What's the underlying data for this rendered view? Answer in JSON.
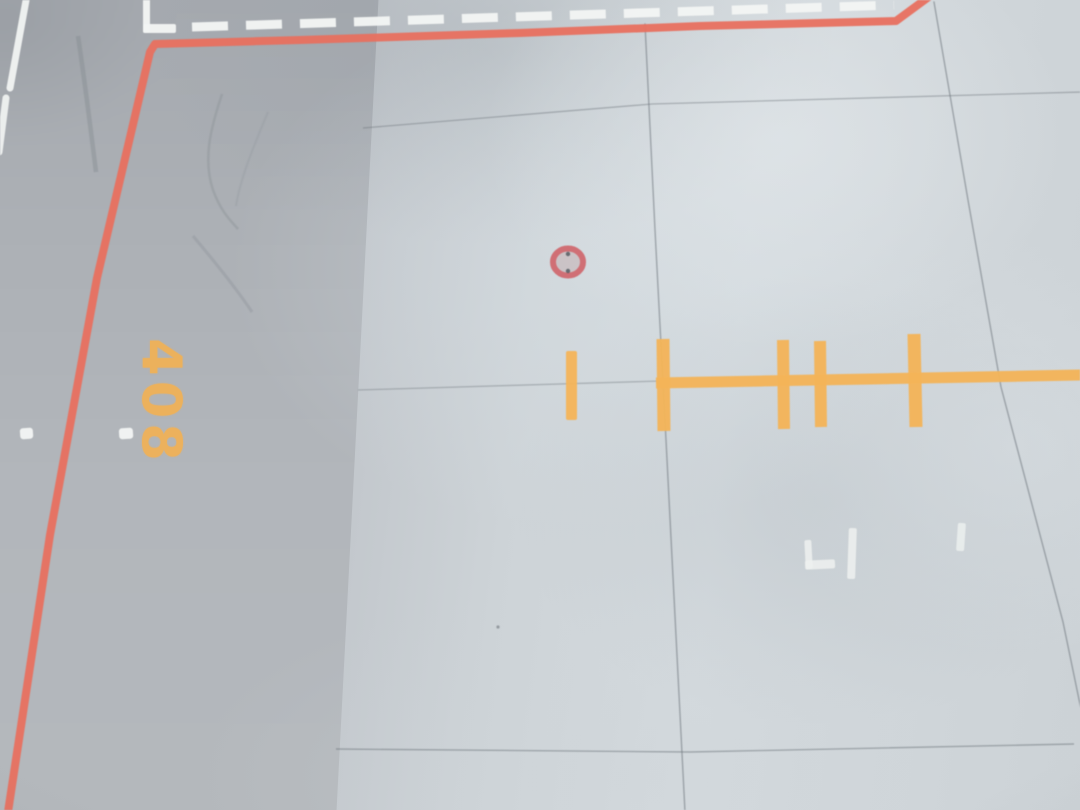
{
  "stand_number": {
    "text": "408",
    "color": "#f1b156"
  },
  "palette": {
    "apron_boundary_red": "#e8705f",
    "marking_yellow": "#f4b458",
    "marking_white": "#f3f5f4",
    "panel_seam_grey": "#6e757c",
    "grommet_ring_red": "#d0666c",
    "grommet_fill": "#c8bcbe",
    "surface_light": "#d4dade",
    "surface_dark": "#a6aaaf"
  },
  "shapes": [
    {
      "tag": "path",
      "name": "wrinkle-crease-1",
      "attrs": {
        "d": "M222,94 C210,130 203,160 213,190 C221,212 231,221 238,229",
        "stroke": "#8f949a",
        "stroke-width": "2.5",
        "fill": "none",
        "opacity": "0.45"
      }
    },
    {
      "tag": "path",
      "name": "wrinkle-crease-2",
      "attrs": {
        "d": "M193,236 C215,262 236,288 252,312",
        "stroke": "#8f949a",
        "stroke-width": "3",
        "fill": "none",
        "opacity": "0.4"
      }
    },
    {
      "tag": "path",
      "name": "wrinkle-crease-3",
      "attrs": {
        "d": "M268,112 C252,150 240,180 236,206",
        "stroke": "#93989e",
        "stroke-width": "2",
        "fill": "none",
        "opacity": "0.32"
      }
    },
    {
      "tag": "path",
      "name": "left-strip-scuff",
      "attrs": {
        "d": "M78,36 C86,90 92,140 96,172",
        "stroke": "#83898f",
        "stroke-width": "4.5",
        "fill": "none",
        "opacity": "0.4"
      }
    },
    {
      "tag": "polyline",
      "name": "panel-seam-vertical-center",
      "attrs": {
        "points": "645,24 655,230 666,440 685,812",
        "stroke": "#6e757c",
        "stroke-width": "1.4",
        "fill": "none",
        "opacity": "0.55",
        "stroke-linecap": "round"
      }
    },
    {
      "tag": "polyline",
      "name": "panel-seam-vertical-right",
      "attrs": {
        "points": "934,2 968,200 1001,387 1063,622 1082,714",
        "stroke": "#6e757c",
        "stroke-width": "1.4",
        "fill": "none",
        "opacity": "0.55",
        "stroke-linecap": "round"
      }
    },
    {
      "tag": "polyline",
      "name": "panel-seam-horizontal-top",
      "attrs": {
        "points": "363,128 652,104 1082,92",
        "stroke": "#6e757c",
        "stroke-width": "1.3",
        "fill": "none",
        "opacity": "0.45"
      }
    },
    {
      "tag": "line",
      "name": "panel-seam-horizontal-middle",
      "attrs": {
        "x1": "358",
        "y1": "390",
        "x2": "660",
        "y2": "381",
        "stroke": "#6e757c",
        "stroke-width": "1.3",
        "opacity": "0.4"
      }
    },
    {
      "tag": "polyline",
      "name": "panel-seam-horizontal-bottom",
      "attrs": {
        "points": "336,749 690,752 1074,744",
        "stroke": "#6e757c",
        "stroke-width": "1.4",
        "fill": "none",
        "opacity": "0.5"
      }
    },
    {
      "tag": "circle",
      "name": "dust-speck",
      "attrs": {
        "cx": "498",
        "cy": "627",
        "r": "1.6",
        "fill": "#7d838a",
        "opacity": "0.7"
      }
    },
    {
      "tag": "polyline",
      "name": "apron-boundary-red-line",
      "attrs": {
        "points": "8,812 50,535 97,278 150,52 155,44 300,40 520,33 700,26 896,21 930,-4",
        "stroke": "#e8705f",
        "stroke-width": "8",
        "fill": "none",
        "opacity": "0.95",
        "stroke-linejoin": "round",
        "stroke-linecap": "round"
      }
    },
    {
      "tag": "line",
      "name": "taxiway-edge-dashed-line",
      "attrs": {
        "x1": "192",
        "y1": "27",
        "x2": "894",
        "y2": "5",
        "stroke": "#f3f5f4",
        "stroke-width": "9",
        "stroke-dasharray": "36 18",
        "opacity": "0.96"
      }
    },
    {
      "tag": "rect",
      "name": "corner-mark-top-left-vertical",
      "attrs": {
        "x": "143",
        "y": "-2",
        "width": "7",
        "height": "35",
        "rx": "2",
        "fill": "#f3f5f4",
        "opacity": "0.96"
      }
    },
    {
      "tag": "rect",
      "name": "corner-mark-top-left-horizontal",
      "attrs": {
        "x": "143",
        "y": "24",
        "width": "33",
        "height": "9",
        "rx": "2",
        "fill": "#f3f5f4",
        "opacity": "0.96"
      }
    },
    {
      "tag": "line",
      "name": "runway-edge-line-upper",
      "attrs": {
        "x1": "27",
        "y1": "-5",
        "x2": "10",
        "y2": "88",
        "stroke": "#f3f5f4",
        "stroke-width": "7",
        "opacity": "0.94",
        "stroke-linecap": "round"
      }
    },
    {
      "tag": "line",
      "name": "runway-edge-line-lower",
      "attrs": {
        "x1": "6",
        "y1": "98",
        "x2": "-1",
        "y2": "152",
        "stroke": "#f3f5f4",
        "stroke-width": "7",
        "opacity": "0.9",
        "stroke-linecap": "round"
      }
    },
    {
      "tag": "rect",
      "name": "edge-dash-left",
      "attrs": {
        "x": "20",
        "y": "428",
        "width": "13",
        "height": "11",
        "rx": "3",
        "fill": "#f3f5f4",
        "opacity": "0.95",
        "transform": "rotate(-4 26 433)"
      }
    },
    {
      "tag": "rect",
      "name": "edge-dash-near-stand-number",
      "attrs": {
        "x": "119",
        "y": "428",
        "width": "14",
        "height": "11",
        "rx": "3",
        "fill": "#f3f5f4",
        "opacity": "0.95",
        "transform": "rotate(-4 126 433)"
      }
    },
    {
      "tag": "rect",
      "name": "yellow-stub-dash",
      "attrs": {
        "x": "566",
        "y": "351",
        "width": "11",
        "height": "69",
        "rx": "2",
        "fill": "#f4b458",
        "opacity": "0.95"
      }
    },
    {
      "tag": "line",
      "name": "stand-lead-in-line",
      "attrs": {
        "x1": "656",
        "y1": "383",
        "x2": "1082",
        "y2": "375",
        "stroke": "#f4b458",
        "stroke-width": "11",
        "opacity": "0.95"
      }
    },
    {
      "tag": "line",
      "name": "lead-in-crossbar-1",
      "attrs": {
        "x1": "663",
        "y1": "339",
        "x2": "664",
        "y2": "431",
        "stroke": "#f4b458",
        "stroke-width": "13",
        "opacity": "0.95"
      }
    },
    {
      "tag": "line",
      "name": "lead-in-crossbar-2",
      "attrs": {
        "x1": "783",
        "y1": "340",
        "x2": "784",
        "y2": "429",
        "stroke": "#f4b458",
        "stroke-width": "12",
        "opacity": "0.95"
      }
    },
    {
      "tag": "line",
      "name": "lead-in-crossbar-3",
      "attrs": {
        "x1": "820",
        "y1": "341",
        "x2": "821",
        "y2": "427",
        "stroke": "#f4b458",
        "stroke-width": "12",
        "opacity": "0.95"
      }
    },
    {
      "tag": "line",
      "name": "lead-in-crossbar-4",
      "attrs": {
        "x1": "914",
        "y1": "334",
        "x2": "916",
        "y2": "427",
        "stroke": "#f4b458",
        "stroke-width": "13",
        "opacity": "0.95"
      }
    },
    {
      "tag": "ellipse",
      "name": "red-grommet-ring",
      "attrs": {
        "cx": "568",
        "cy": "262",
        "rx": "15",
        "ry": "13.5",
        "fill": "#c8bcbe",
        "fill-opacity": "0.8",
        "stroke": "#d0666c",
        "stroke-width": "6",
        "opacity": "0.92"
      }
    },
    {
      "tag": "circle",
      "name": "grommet-dot-top",
      "attrs": {
        "cx": "568",
        "cy": "254",
        "r": "2.2",
        "fill": "#555a60",
        "opacity": "0.85"
      }
    },
    {
      "tag": "circle",
      "name": "grommet-dot-bottom",
      "attrs": {
        "cx": "568",
        "cy": "271",
        "r": "2.2",
        "fill": "#555a60",
        "opacity": "0.85"
      }
    },
    {
      "tag": "rect",
      "name": "corner-mark-stand-L-vertical",
      "attrs": {
        "x": "805",
        "y": "540",
        "width": "7",
        "height": "29",
        "rx": "2",
        "fill": "#eef1f0",
        "opacity": "0.85",
        "transform": "rotate(-3 808 554)"
      }
    },
    {
      "tag": "rect",
      "name": "corner-mark-stand-L-horizontal",
      "attrs": {
        "x": "805",
        "y": "560",
        "width": "30",
        "height": "9",
        "rx": "2",
        "fill": "#eef1f0",
        "opacity": "0.85",
        "transform": "rotate(-3 820 564)"
      }
    },
    {
      "tag": "rect",
      "name": "stand-mark-vertical-bar",
      "attrs": {
        "x": "848",
        "y": "528",
        "width": "8",
        "height": "51",
        "rx": "2",
        "fill": "#eef1f0",
        "opacity": "0.85",
        "transform": "rotate(2 852 553)"
      }
    },
    {
      "tag": "rect",
      "name": "stand-mark-short-dash",
      "attrs": {
        "x": "957",
        "y": "523",
        "width": "8",
        "height": "28",
        "rx": "2",
        "fill": "#eef1f0",
        "opacity": "0.8",
        "transform": "rotate(4 961 537)"
      }
    }
  ]
}
